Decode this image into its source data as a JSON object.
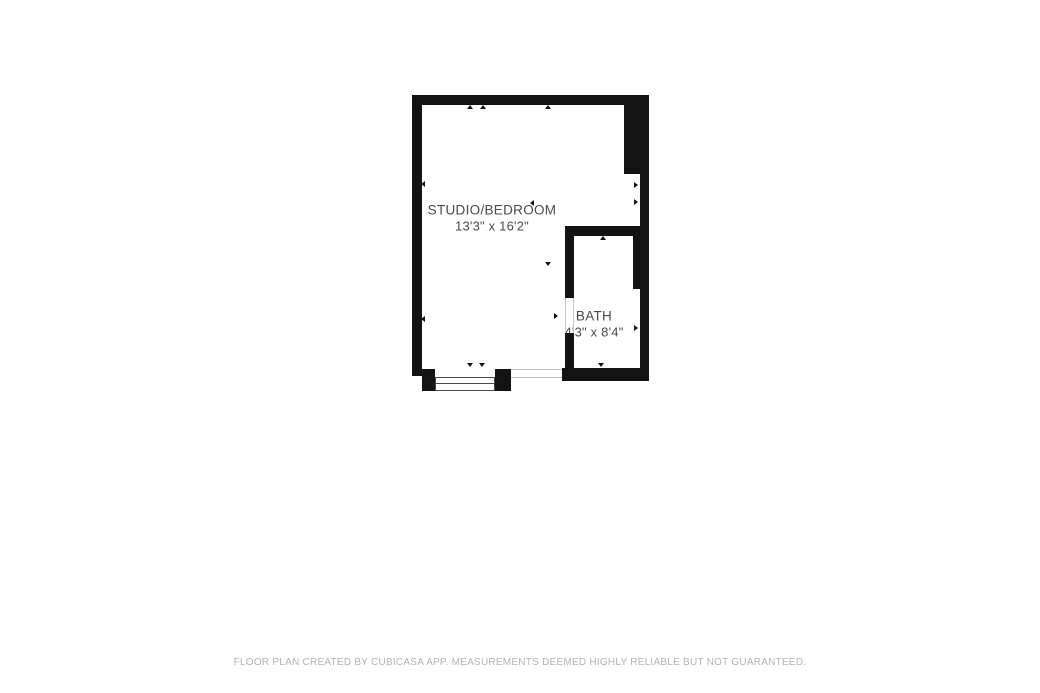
{
  "colors": {
    "wall": "#131313",
    "thin_line": "#c6c6c6",
    "room_text": "#4a4a4a",
    "footer_text": "#b3b3b3",
    "background": "#ffffff"
  },
  "plan": {
    "rooms": [
      {
        "id": "studio",
        "name": "STUDIO/BEDROOM",
        "dims": "13'3\" x 16'2\"",
        "cx": 492,
        "cy": 218
      },
      {
        "id": "bath",
        "name": "BATH",
        "dims": "4'3\" x 8'4\"",
        "cx": 594,
        "cy": 324
      }
    ],
    "walls": [
      {
        "x": 412,
        "y": 95,
        "w": 237,
        "h": 10
      },
      {
        "x": 412,
        "y": 95,
        "w": 10,
        "h": 281
      },
      {
        "x": 624,
        "y": 95,
        "w": 25,
        "h": 79
      },
      {
        "x": 640,
        "y": 95,
        "w": 9,
        "h": 286
      },
      {
        "x": 565,
        "y": 226,
        "w": 84,
        "h": 10
      },
      {
        "x": 633,
        "y": 226,
        "w": 9,
        "h": 63
      },
      {
        "x": 565,
        "y": 226,
        "w": 9,
        "h": 72
      },
      {
        "x": 565,
        "y": 333,
        "w": 9,
        "h": 48
      },
      {
        "x": 562,
        "y": 368,
        "w": 87,
        "h": 13
      },
      {
        "x": 422,
        "y": 369,
        "w": 13,
        "h": 22
      },
      {
        "x": 495,
        "y": 369,
        "w": 16,
        "h": 22
      }
    ],
    "window": {
      "x": 435,
      "y": 377,
      "w": 60,
      "h": 14
    },
    "thin_lines": [
      {
        "x": 511,
        "y": 369,
        "w": 51,
        "h": 1
      },
      {
        "x": 511,
        "y": 377,
        "w": 51,
        "h": 1
      },
      {
        "x": 565,
        "y": 298,
        "w": 1,
        "h": 35
      },
      {
        "x": 573,
        "y": 298,
        "w": 1,
        "h": 35
      }
    ],
    "markers": [
      {
        "x": 470,
        "y": 107,
        "dir": "up"
      },
      {
        "x": 483,
        "y": 107,
        "dir": "up"
      },
      {
        "x": 548,
        "y": 107,
        "dir": "up"
      },
      {
        "x": 424,
        "y": 183,
        "dir": "left"
      },
      {
        "x": 424,
        "y": 318,
        "dir": "left"
      },
      {
        "x": 533,
        "y": 202,
        "dir": "left"
      },
      {
        "x": 548,
        "y": 264,
        "dir": "down"
      },
      {
        "x": 637,
        "y": 184,
        "dir": "right"
      },
      {
        "x": 637,
        "y": 201,
        "dir": "right"
      },
      {
        "x": 603,
        "y": 238,
        "dir": "up"
      },
      {
        "x": 557,
        "y": 315,
        "dir": "right"
      },
      {
        "x": 637,
        "y": 327,
        "dir": "right"
      },
      {
        "x": 601,
        "y": 365,
        "dir": "down"
      },
      {
        "x": 470,
        "y": 365,
        "dir": "down"
      },
      {
        "x": 482,
        "y": 365,
        "dir": "down"
      }
    ]
  },
  "footer": {
    "text": "FLOOR PLAN CREATED BY CUBICASA APP. MEASUREMENTS DEEMED HIGHLY RELIABLE BUT NOT GUARANTEED."
  }
}
